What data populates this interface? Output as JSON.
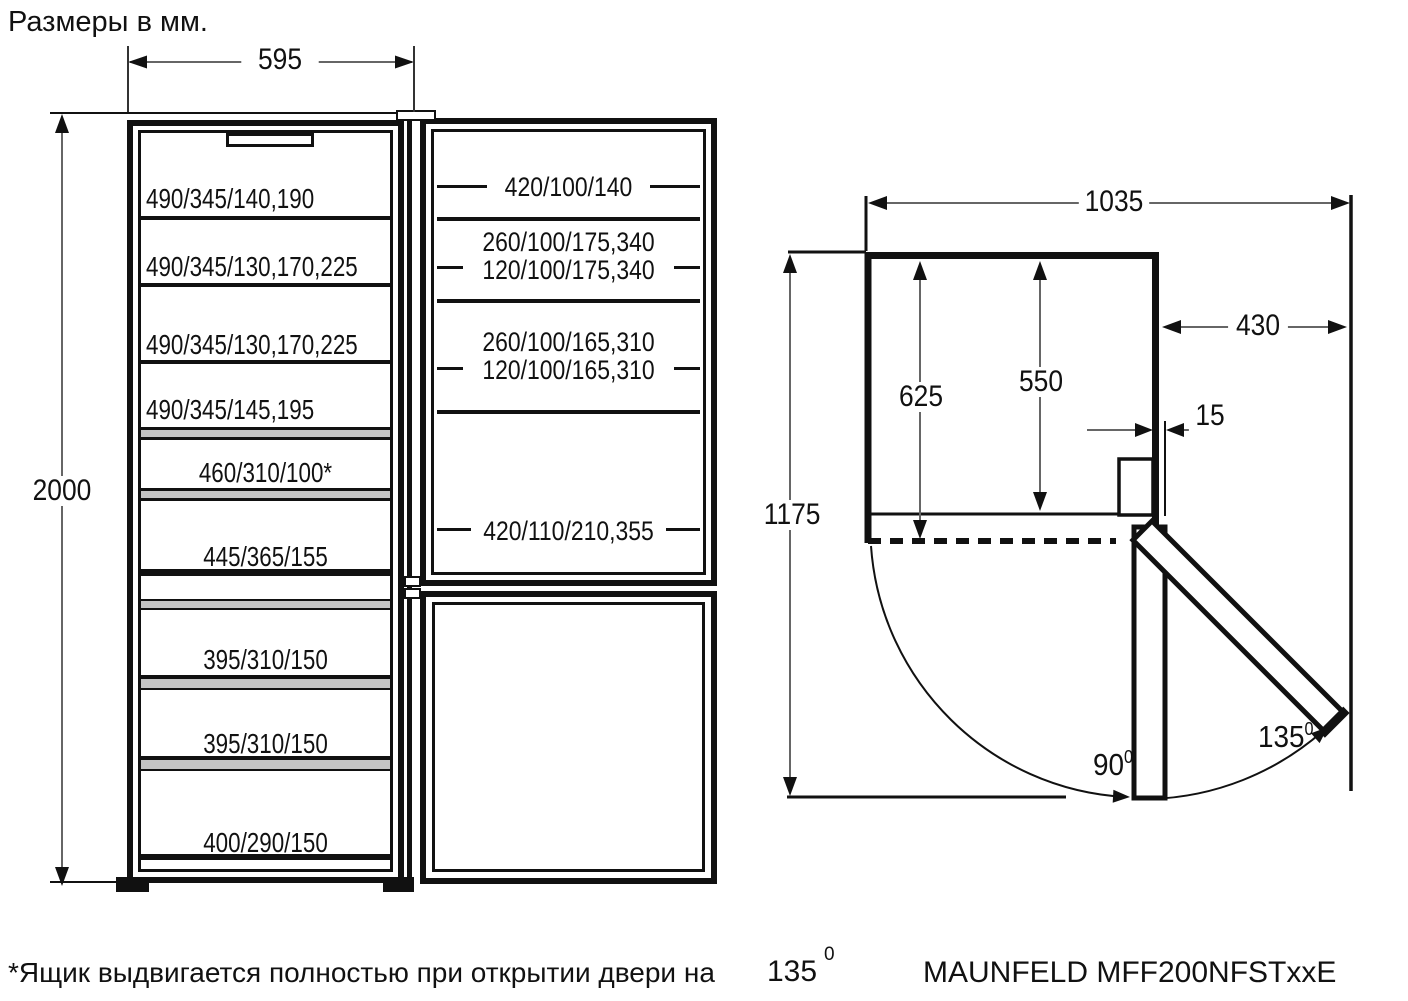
{
  "title": "Размеры в мм.",
  "front_view": {
    "dims": {
      "width": "595",
      "height": "2000"
    },
    "cabinet_shelves": [
      "490/345/140,190",
      "490/345/130,170,225",
      "490/345/130,170,225",
      "490/345/145,195",
      "460/310/100*",
      "445/365/155"
    ],
    "freezer_drawers": [
      "395/310/150",
      "395/310/150",
      "400/290/150"
    ],
    "door_pockets": {
      "row1": "420/100/140",
      "row2a": "260/100/175,340",
      "row2b": "120/100/175,340",
      "row3a": "260/100/165,310",
      "row3b": "120/100/165,310",
      "row4": "420/110/210,355"
    }
  },
  "top_view": {
    "dims": {
      "total_width": "1035",
      "door_open_side": "430",
      "depth_with_door": "625",
      "depth_body": "550",
      "door_protrusion": "15",
      "total_depth_open": "1175"
    },
    "angles": {
      "open_90": "90",
      "open_90_sup": "0",
      "open_135": "135",
      "open_135_sup": "0"
    }
  },
  "footer": {
    "note": "*Ящик выдвигается полностью при открытии двери на",
    "note_angle": "135",
    "note_angle_sup": "0",
    "model": "MAUNFELD MFF200NFSTxxE"
  },
  "colors": {
    "ink": "#111111",
    "dim_line": "#666666",
    "shelf_gray": "#c4c4c4"
  }
}
